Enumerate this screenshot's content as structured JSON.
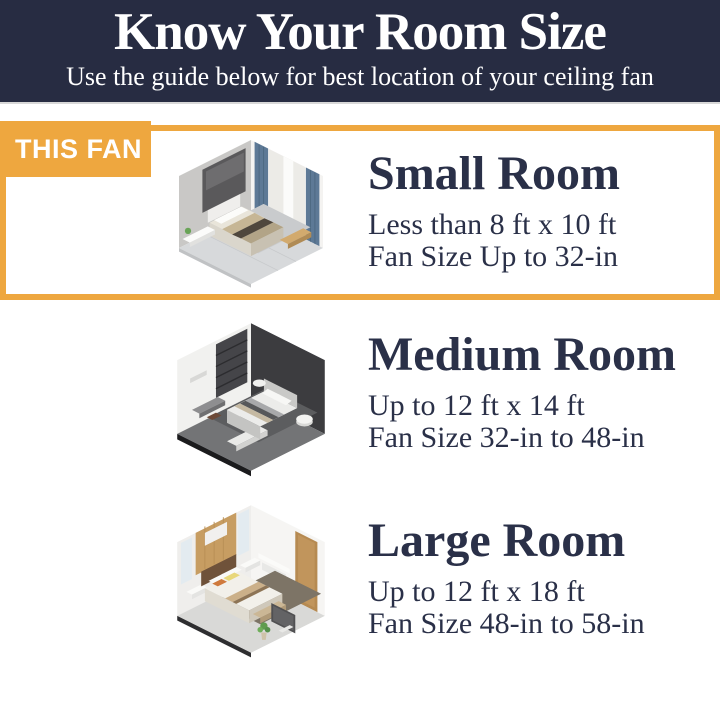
{
  "colors": {
    "page_bg": "#ffffff",
    "header_bg": "#272c42",
    "accent_orange": "#eea73f",
    "text_navy": "#2a3048",
    "text_light": "#ffffff"
  },
  "header": {
    "title": "Know Your Room Size",
    "subtitle": "Use the guide below for best location of your ceiling fan"
  },
  "badge": {
    "label": "THIS FAN"
  },
  "sections": [
    {
      "id": "small-room",
      "highlighted": true,
      "heading": "Small Room",
      "dimensions": "Less than 8 ft x 10 ft",
      "fan_size": "Fan Size Up to 32-in",
      "illustration": "isometric-small-bedroom"
    },
    {
      "id": "medium-room",
      "highlighted": false,
      "heading": "Medium Room",
      "dimensions": "Up to 12 ft x 14 ft",
      "fan_size": "Fan Size 32-in to 48-in",
      "illustration": "isometric-medium-bedroom"
    },
    {
      "id": "large-room",
      "highlighted": false,
      "heading": "Large Room",
      "dimensions": "Up to 12 ft x 18 ft",
      "fan_size": "Fan Size 48-in to 58-in",
      "illustration": "isometric-large-bedroom"
    }
  ]
}
